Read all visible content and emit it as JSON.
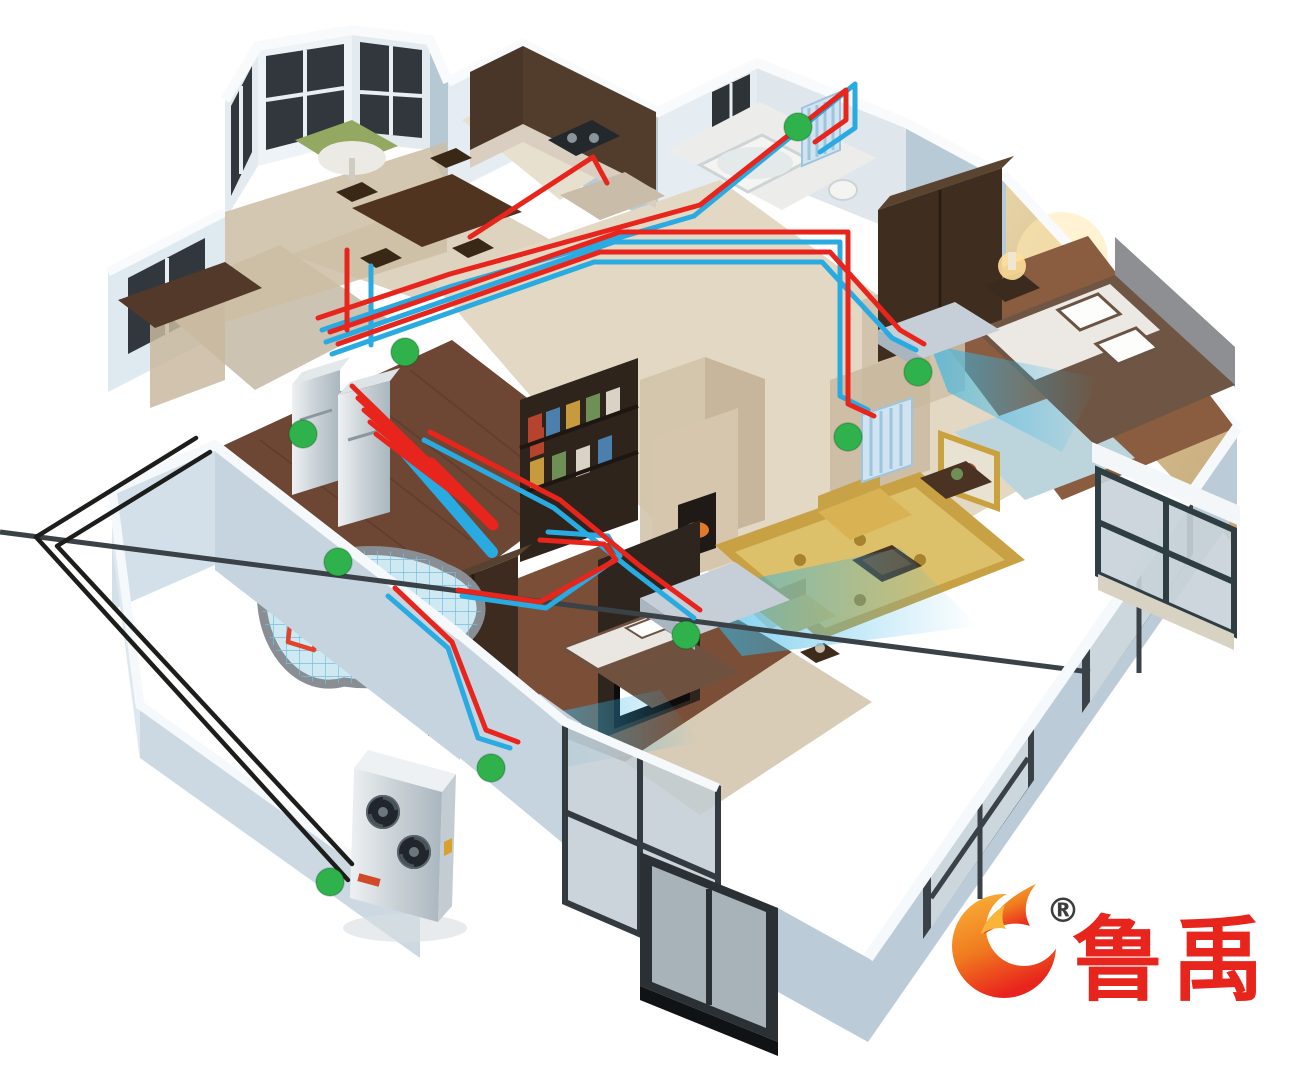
{
  "logo": {
    "brand_text": "鲁禹",
    "registered_mark": "®",
    "text_color": "#e8251d",
    "mark_gradient": [
      "#f9b53a",
      "#e8251d"
    ]
  },
  "colors": {
    "supply_pipe": "#e8251d",
    "return_pipe": "#29abe2",
    "ground_loop": "#1d1d1b",
    "marker": "#2fb14b",
    "airflow": "#35b5e5",
    "exterior_wall": "#b7c8d5",
    "radiator": "#cfe4f0"
  },
  "diagram": {
    "type": "hvac-floorplan-cutaway",
    "markers": [
      [
        798,
        127
      ],
      [
        405,
        352
      ],
      [
        303,
        434
      ],
      [
        918,
        372
      ],
      [
        848,
        437
      ],
      [
        338,
        562
      ],
      [
        686,
        635
      ],
      [
        491,
        768
      ],
      [
        330,
        882
      ]
    ],
    "pipes": {
      "supply": [
        [
          [
            700,
            205
          ],
          [
            846,
            90
          ],
          [
            846,
            120
          ],
          [
            815,
            142
          ]
        ],
        [
          [
            470,
            237
          ],
          [
            593,
            157
          ],
          [
            607,
            183
          ]
        ],
        [
          [
            318,
            318
          ],
          [
            450,
            274
          ],
          [
            700,
            205
          ]
        ],
        [
          [
            330,
            332
          ],
          [
            620,
            232
          ],
          [
            848,
            232
          ],
          [
            848,
            404
          ],
          [
            874,
            416
          ]
        ],
        [
          [
            338,
            344
          ],
          [
            600,
            252
          ],
          [
            830,
            252
          ],
          [
            900,
            330
          ],
          [
            924,
            344
          ]
        ],
        [
          [
            430,
            432
          ],
          [
            560,
            500
          ],
          [
            640,
            566
          ],
          [
            700,
            610
          ]
        ],
        [
          [
            540,
            540
          ],
          [
            604,
            544
          ],
          [
            616,
            560
          ],
          [
            540,
            602
          ],
          [
            458,
            590
          ]
        ],
        [
          [
            395,
            588
          ],
          [
            452,
            642
          ],
          [
            486,
            730
          ],
          [
            518,
            742
          ]
        ],
        [
          [
            347,
            250
          ],
          [
            347,
            330
          ]
        ],
        [
          [
            352,
            386
          ],
          [
            438,
            470
          ]
        ],
        [
          [
            358,
            398
          ],
          [
            450,
            482
          ]
        ],
        [
          [
            364,
            410
          ],
          [
            462,
            494
          ]
        ],
        [
          [
            370,
            422
          ],
          [
            474,
            506
          ]
        ],
        [
          [
            376,
            434
          ],
          [
            486,
            518
          ]
        ]
      ],
      "supply_caps": [
        [
          [
            431,
            463
          ],
          [
            445,
            477
          ]
        ],
        [
          [
            443,
            475
          ],
          [
            457,
            489
          ]
        ],
        [
          [
            455,
            487
          ],
          [
            469,
            501
          ]
        ],
        [
          [
            467,
            499
          ],
          [
            481,
            513
          ]
        ],
        [
          [
            479,
            511
          ],
          [
            493,
            525
          ]
        ]
      ],
      "return": [
        [
          [
            694,
            216
          ],
          [
            855,
            84
          ],
          [
            855,
            128
          ],
          [
            820,
            152
          ]
        ],
        [
          [
            322,
            330
          ],
          [
            452,
            286
          ],
          [
            694,
            216
          ]
        ],
        [
          [
            326,
            342
          ],
          [
            614,
            242
          ],
          [
            840,
            242
          ],
          [
            840,
            396
          ],
          [
            868,
            410
          ]
        ],
        [
          [
            332,
            354
          ],
          [
            594,
            262
          ],
          [
            822,
            262
          ],
          [
            892,
            338
          ],
          [
            916,
            350
          ]
        ],
        [
          [
            424,
            440
          ],
          [
            554,
            508
          ],
          [
            634,
            572
          ],
          [
            694,
            618
          ]
        ],
        [
          [
            548,
            532
          ],
          [
            608,
            536
          ],
          [
            620,
            556
          ],
          [
            546,
            608
          ],
          [
            462,
            596
          ]
        ],
        [
          [
            388,
            596
          ],
          [
            448,
            648
          ],
          [
            478,
            738
          ],
          [
            510,
            748
          ]
        ],
        [
          [
            371,
            266
          ],
          [
            371,
            345
          ]
        ]
      ],
      "return_trunk": [
        [
          406,
          453
        ],
        [
          492,
          552
        ]
      ],
      "ground_loop": [
        [
          [
            196,
            438
          ],
          [
            36,
            537
          ],
          [
            348,
            880
          ]
        ],
        [
          [
            210,
            452
          ],
          [
            57,
            546
          ],
          [
            352,
            864
          ]
        ]
      ]
    },
    "components": [
      {
        "id": "outdoor-heat-pump-unit",
        "x": 400,
        "y": 840
      },
      {
        "id": "indoor-unit-water-tank",
        "x": 340,
        "y": 430
      },
      {
        "id": "distribution-manifold",
        "x": 450,
        "y": 500
      },
      {
        "id": "underfloor-heating-coil",
        "x": 360,
        "y": 620
      },
      {
        "id": "radiator-bathroom",
        "x": 820,
        "y": 128
      },
      {
        "id": "radiator-hallway",
        "x": 887,
        "y": 440
      },
      {
        "id": "fan-coil-bedroom",
        "x": 935,
        "y": 330
      },
      {
        "id": "fan-coil-living-room",
        "x": 715,
        "y": 600
      },
      {
        "id": "fan-coil-second-bedroom",
        "x": 520,
        "y": 722
      },
      {
        "id": "ground-loop-piping",
        "x": 190,
        "y": 650
      }
    ]
  }
}
